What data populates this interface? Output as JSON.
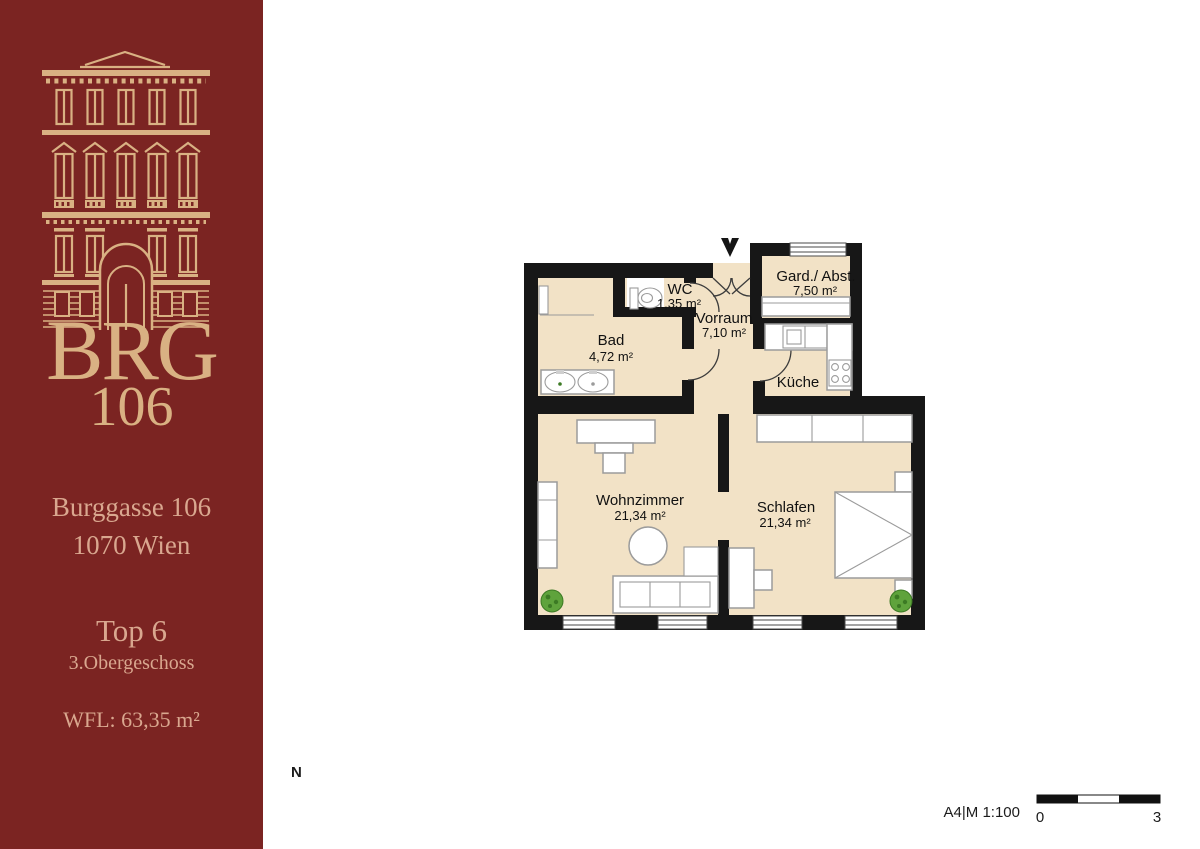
{
  "sidebar": {
    "logo_line1": "BRG",
    "logo_line2": "106",
    "address_line1": "Burggasse 106",
    "address_line2": "1070 Wien",
    "unit": "Top 6",
    "floor": "3.Obergeschoss",
    "area_label": "WFL: 63,35 m²"
  },
  "plan": {
    "rooms": [
      {
        "name": "WC",
        "area": "1,35 m²"
      },
      {
        "name": "Gard./ Abst.",
        "area": "7,50 m²"
      },
      {
        "name": "Vorraum",
        "area": "7,10 m²"
      },
      {
        "name": "Bad",
        "area": "4,72 m²"
      },
      {
        "name": "Küche",
        "area": ""
      },
      {
        "name": "Wohnzimmer",
        "area": "21,34 m²"
      },
      {
        "name": "Schlafen",
        "area": "21,34 m²"
      }
    ],
    "north_label": "N",
    "scale_text": "A4|M 1:100",
    "scale_start": "0",
    "scale_end": "3"
  },
  "colors": {
    "sidebar_bg": "#7b2422",
    "logo_gold": "#d9b183",
    "address_tan": "#d9a78f",
    "floor_fill": "#f2e2c6",
    "wall_black": "#171717",
    "plant_green": "#5fa33c"
  }
}
